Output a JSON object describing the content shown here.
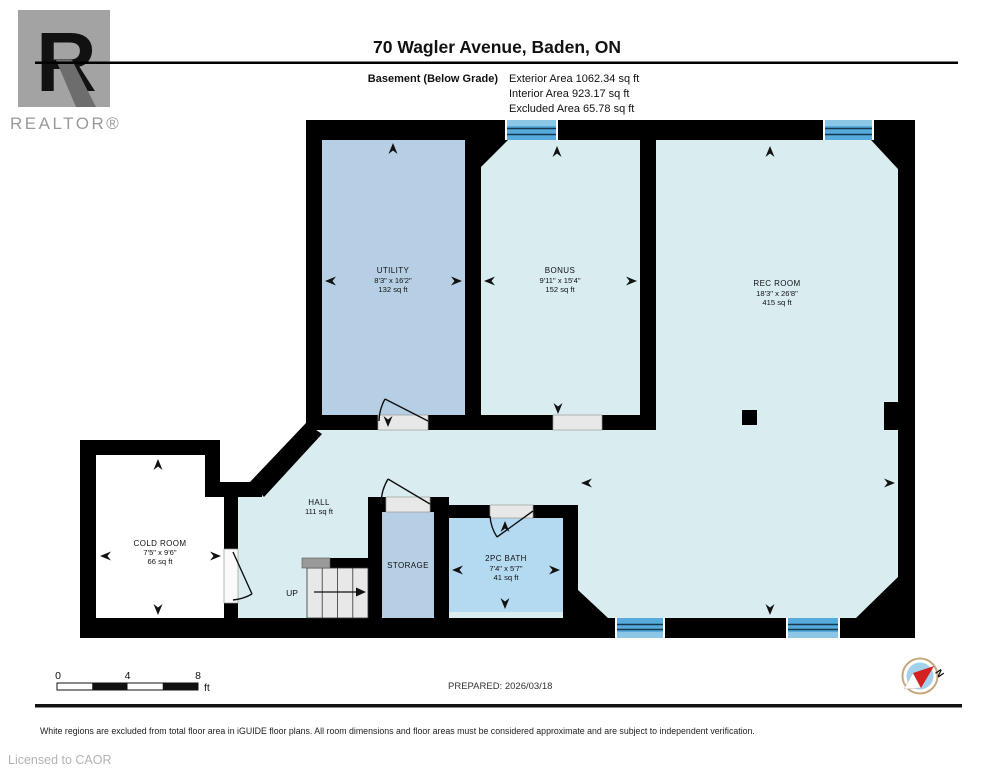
{
  "header": {
    "title": "70 Wagler Avenue, Baden, ON",
    "floor_label": "Basement (Below Grade)",
    "exterior_area": "Exterior Area 1062.34 sq ft",
    "interior_area": "Interior Area 923.17 sq ft",
    "excluded_area": "Excluded Area 65.78 sq ft",
    "logo_text": "REALTOR®",
    "logo_letter": "R"
  },
  "rooms": {
    "utility": {
      "name": "UTILITY",
      "dims": "8'3\" x 16'2\"",
      "area": "132 sq ft"
    },
    "bonus": {
      "name": "BONUS",
      "dims": "9'11\" x 15'4\"",
      "area": "152 sq ft"
    },
    "rec_room": {
      "name": "REC ROOM",
      "dims": "18'3\" x 26'8\"",
      "area": "415 sq ft"
    },
    "cold_room": {
      "name": "COLD ROOM",
      "dims": "7'5\" x 9'6\"",
      "area": "66 sq ft"
    },
    "hall": {
      "name": "HALL",
      "area": "111 sq ft"
    },
    "storage": {
      "name": "STORAGE"
    },
    "bath": {
      "name": "2PC BATH",
      "dims": "7'4\" x 5'7\"",
      "area": "41 sq ft"
    }
  },
  "stairs": {
    "label": "UP"
  },
  "footer": {
    "scale_ticks": [
      "0",
      "4",
      "8"
    ],
    "scale_unit": "ft",
    "prepared": "PREPARED: 2026/03/18",
    "compass_label": "N",
    "disclaimer": "White regions are excluded from total floor area in iGUIDE floor plans. All room dimensions and floor areas must be considered approximate and are subject to independent verification.",
    "licensed": "Licensed to CAOR"
  },
  "colors": {
    "wall": "#000000",
    "floor_light": "#d9edf0",
    "floor_medium": "#b6cfe4",
    "bath_blue": "#b4daf2",
    "excluded_white": "#ffffff",
    "window_blue": "#57abdc",
    "window_line": "#16384f",
    "compass_red": "#d42020",
    "compass_ring": "#c8a87a",
    "compass_fill": "#a3d1ea"
  }
}
